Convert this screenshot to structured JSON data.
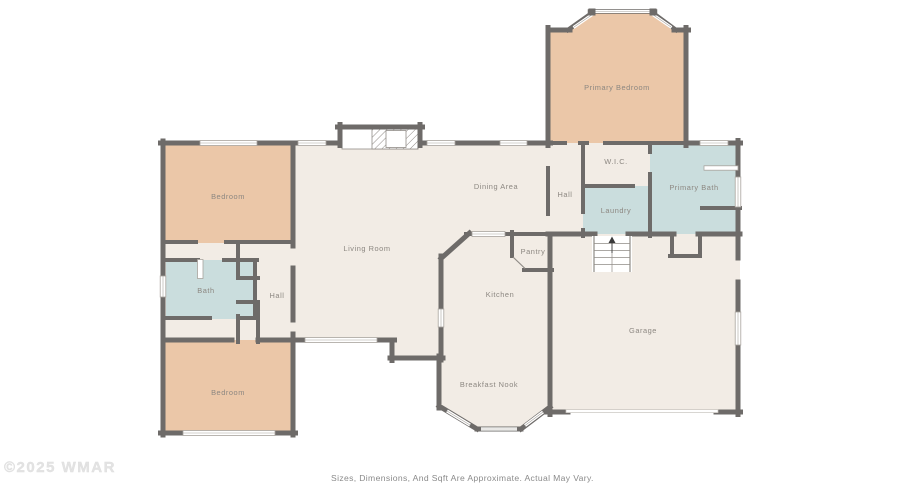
{
  "page": {
    "watermark": "©2025 WMAR",
    "disclaimer": "Sizes, Dimensions, And Sqft Are Approximate. Actual May Vary."
  },
  "colors": {
    "wall": "#6e6b69",
    "bedroom_fill": "#ebc7a8",
    "wet_room_fill": "#cadddd",
    "living_fill": "#f2ece5",
    "label_text": "#8c8781"
  },
  "rooms": {
    "primary_bedroom": {
      "label": "Primary Bedroom"
    },
    "wic": {
      "label": "W.I.C."
    },
    "primary_bath": {
      "label": "Primary Bath"
    },
    "hall_upper": {
      "label": "Hall"
    },
    "laundry": {
      "label": "Laundry"
    },
    "dining_area": {
      "label": "Dining Area"
    },
    "living_room": {
      "label": "Living Room"
    },
    "pantry": {
      "label": "Pantry"
    },
    "kitchen": {
      "label": "Kitchen"
    },
    "breakfast_nook": {
      "label": "Breakfast Nook"
    },
    "garage": {
      "label": "Garage"
    },
    "bedroom_top": {
      "label": "Bedroom"
    },
    "bath": {
      "label": "Bath"
    },
    "hall_left": {
      "label": "Hall"
    },
    "bedroom_bottom": {
      "label": "Bedroom"
    }
  }
}
